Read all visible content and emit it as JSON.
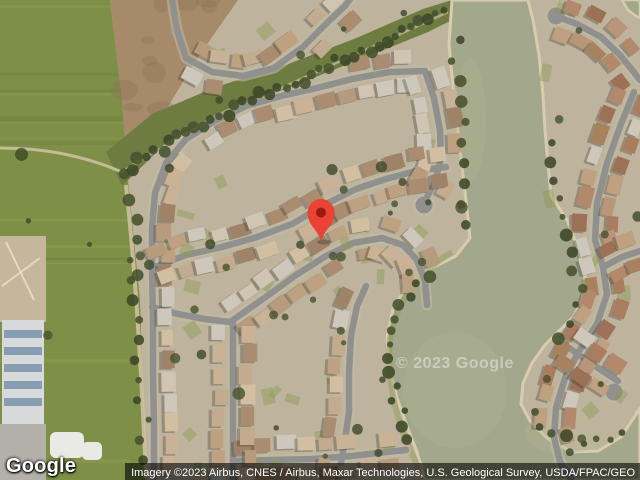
{
  "map": {
    "provider_logo": "Google",
    "watermark": "© 2023 Google",
    "attribution": "Imagery ©2023 Airbus, CNES / Airbus, Maxar Technologies, U.S. Geological Survey, USDA/FPAC/GEO",
    "view": "satellite",
    "marker": {
      "x": 321,
      "y": 241,
      "color": "#EA4335",
      "dot_color": "#9A1A10"
    }
  },
  "palette": {
    "ground": "#beb49e",
    "grass": "#7e8f48",
    "grass_light": "#9aab5b",
    "grass_dark": "#5f7036",
    "dirt": "#a78a69",
    "dirt_dark": "#8b7152",
    "belt": "#6e7c42",
    "water": "#a3a78b",
    "water_light": "#b6b999",
    "sand": "#d7cdae",
    "street": "#90918f",
    "street_casing": "#c3bba6",
    "trail": "#cdc1a0",
    "tree": "#47522e",
    "tree2": "#3c4827",
    "lawn": "#8e9a55",
    "shadow": "#3a3830",
    "school_roof": "#d7d9da",
    "solar": "#7e96ad",
    "apron": "#b3b0aa",
    "park": "#c6b79c",
    "white_roof": "#e9e9e6",
    "roof_gray": "#cdc8bb",
    "roofs_left": [
      "#c9b295",
      "#bda181",
      "#d2bfa2",
      "#b69b7c",
      "#aa8d70",
      "#c2ab8e",
      "#cfc5b2",
      "#9f8368"
    ],
    "roofs_right": [
      "#aa7c60",
      "#9d7156",
      "#b28a6b",
      "#bfa07f",
      "#a8815f",
      "#b99579"
    ]
  }
}
